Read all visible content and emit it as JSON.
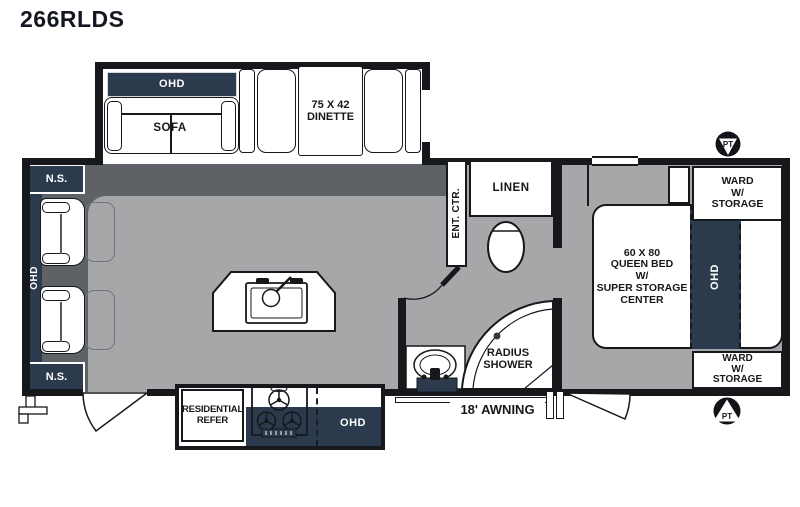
{
  "title": "266RLDS",
  "colors": {
    "navy": "#2b3a4d",
    "floor_dark": "#5e6267",
    "floor_light": "#a6a7a9",
    "wall": "#17181c"
  },
  "labels": {
    "sofa_ohd": "OHD",
    "sofa": "SOFA",
    "dinette_size": "75 X 42",
    "dinette": "DINETTE",
    "ns_top": "N.S.",
    "ns_bottom": "N.S.",
    "rear_ohd": "OHD",
    "ent_ctr": "ENT. CTR.",
    "linen": "LINEN",
    "shower1": "RADIUS",
    "shower2": "SHOWER",
    "bed1": "60 X 80",
    "bed2": "QUEEN BED",
    "bed3": "W/",
    "bed4": "SUPER STORAGE",
    "bed5": "CENTER",
    "bed_ohd": "OHD",
    "ward1": "WARD",
    "ward2": "W/",
    "ward3": "STORAGE",
    "refer1": "RESIDENTIAL",
    "refer2": "REFER",
    "kitchen_ohd": "OHD",
    "awning": "18' AWNING",
    "pt": "PT"
  }
}
